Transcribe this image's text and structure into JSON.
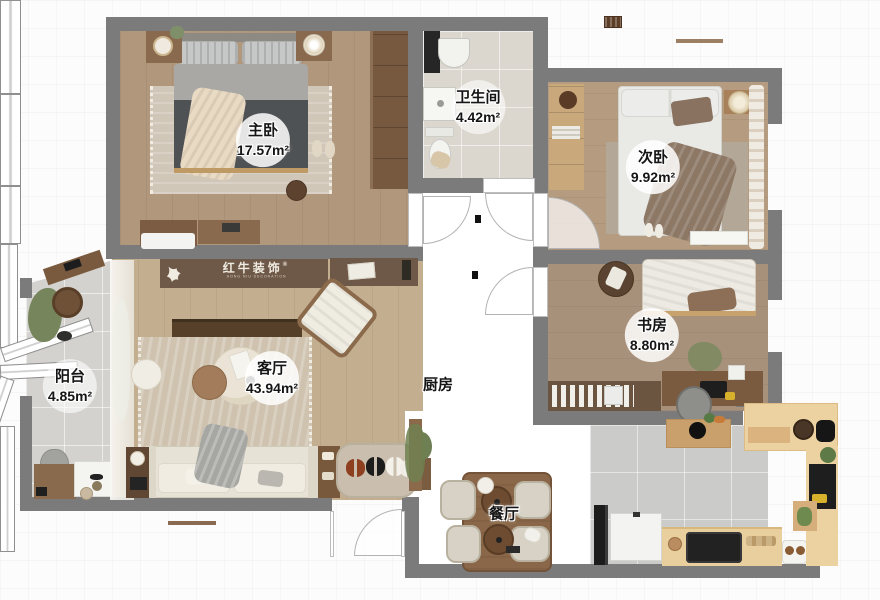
{
  "title": "apartment-floor-plan",
  "logo": {
    "brand": "红牛装饰",
    "subtitle": "HONG NIU DECORATION",
    "registered": "®"
  },
  "rooms": {
    "master": {
      "name": "主卧",
      "area": "17.57m²"
    },
    "bathroom": {
      "name": "卫生间",
      "area": "4.42m²"
    },
    "bedroom2": {
      "name": "次卧",
      "area": "9.92m²"
    },
    "study": {
      "name": "书房",
      "area": "8.80m²"
    },
    "balcony": {
      "name": "阳台",
      "area": "4.85m²"
    },
    "living": {
      "name": "客厅",
      "area": "43.94m²"
    },
    "kitchen": {
      "name": "厨房",
      "area": ""
    },
    "dining": {
      "name": "餐厅",
      "area": ""
    }
  },
  "colors": {
    "wall": "#7b7b7b",
    "wood_master": "#b1987c",
    "wood_living": "#c4ae90",
    "wood_counter": "#e9cf9e",
    "tile_bath": "#dcd7ce",
    "tile_kitchen": "#cbcbc9",
    "banner_brown": "#6e5949"
  }
}
